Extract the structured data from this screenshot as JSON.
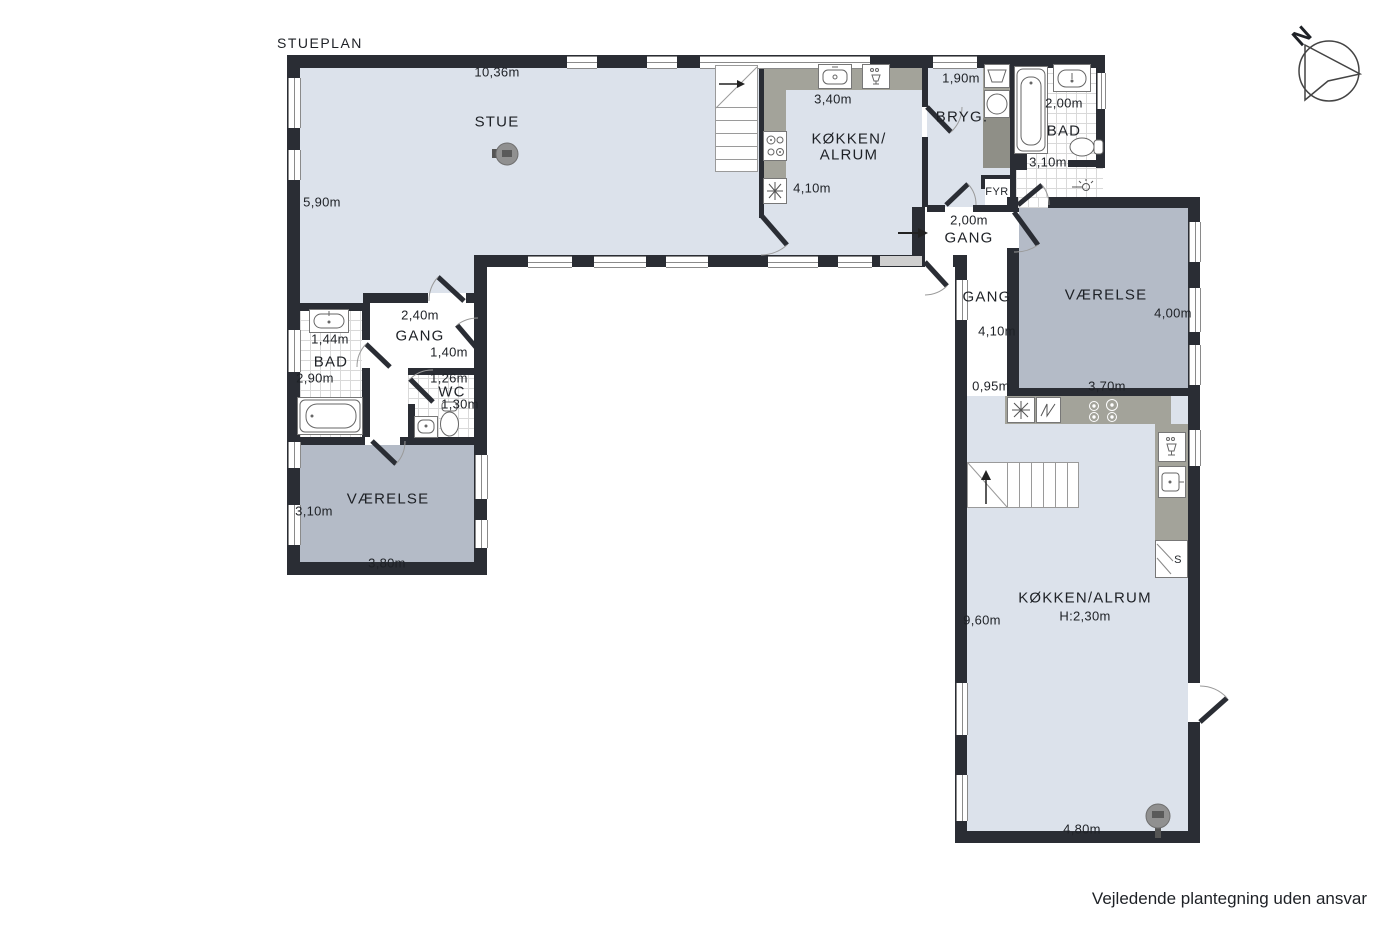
{
  "title": "STUEPLAN",
  "disclaimer": "Vejledende plantegning uden ansvar",
  "compass": {
    "north_label": "N"
  },
  "colors": {
    "wall": "#2a2d34",
    "floor_light": "#dce2eb",
    "floor_dark": "#b4bbc7",
    "counter": "#a3a39a",
    "text": "#1e2126"
  },
  "icons": [
    "compass-rose-icon",
    "stove-pejs-icon",
    "stair-arrow-icon",
    "entry-arrow-icon",
    "sink-icon",
    "dishwasher-icon",
    "cooktop-icon",
    "fridge-icon",
    "oven-icon",
    "washing-machine-icon",
    "laundry-sink-icon",
    "bathtub-icon",
    "toilet-icon",
    "shower-icon"
  ],
  "rooms": {
    "stue": {
      "name": "STUE",
      "width": "10,36m",
      "depth": "5,90m"
    },
    "koekken_alrum": {
      "name_line1": "KØKKEN/",
      "name_line2": "ALRUM",
      "width": "3,40m",
      "depth": "4,10m"
    },
    "bryggers": {
      "name": "BRYG.",
      "width": "1,90m"
    },
    "bad_ne": {
      "name": "BAD",
      "width": "2,00m",
      "depth": "3,10m"
    },
    "fyr": {
      "name": "FYR"
    },
    "gang_entre": {
      "name": "GANG",
      "width": "2,00m"
    },
    "gang_oest": {
      "name": "GANG",
      "depth": "4,10m",
      "width": "0,95m"
    },
    "vaerelse_oest": {
      "name": "VÆRELSE",
      "depth": "4,00m",
      "width": "3,70m"
    },
    "koekken_alrum_syd": {
      "name": "KØKKEN/ALRUM",
      "ceiling_height": "H:2,30m",
      "depth": "9,60m",
      "width": "4,80m"
    },
    "skab": {
      "name": "S"
    },
    "gang_vest": {
      "name": "GANG",
      "width": "2,40m",
      "width_2": "1,40m"
    },
    "bad_vest": {
      "name": "BAD",
      "width": "1,44m",
      "depth": "2,90m"
    },
    "wc": {
      "name": "WC",
      "width": "1,26m",
      "depth": "1,30m"
    },
    "vaerelse_vest": {
      "name": "VÆRELSE",
      "depth": "3,10m",
      "width": "3,80m"
    }
  }
}
